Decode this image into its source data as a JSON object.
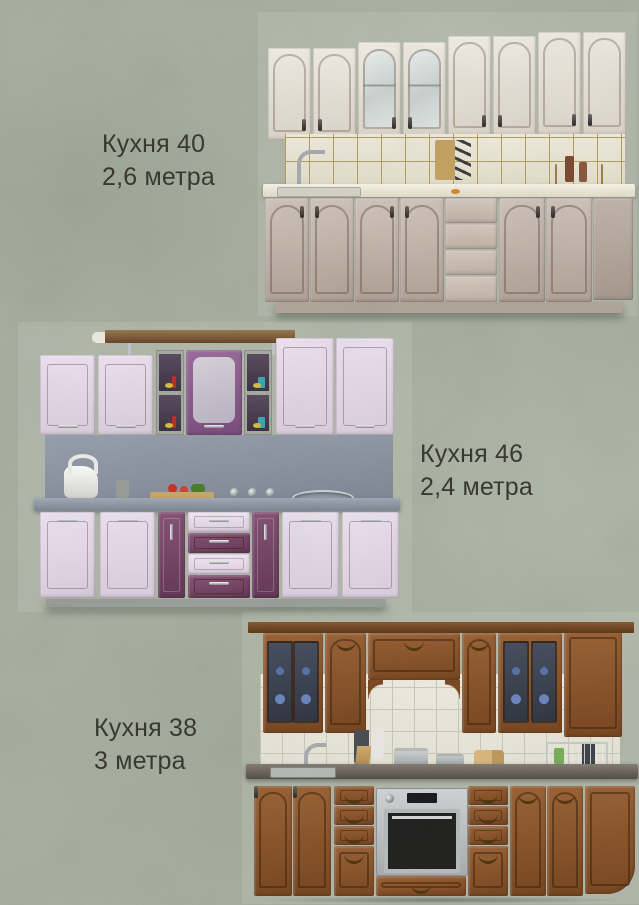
{
  "page": {
    "background_color": "#a9b1a2",
    "texture": "mottled gray-green stucco",
    "text_color": "#3a3a33"
  },
  "kitchens": [
    {
      "label": "Кухня 40",
      "dimension": "2,6 метра",
      "caption_side": "left-of-photo",
      "style": "classic cream set with arched fronts, two glass upper doors, beige tiled splashback, drawer stack",
      "colors": {
        "upper_doors": "#ece7df",
        "lower_doors": "#c4b7ad",
        "tile": "#ece7d6",
        "grout": "#b79d62",
        "countertop": "#f4f1e4"
      }
    },
    {
      "label": "Кухня  46",
      "dimension": "2,4 метра",
      "caption_side": "right-of-photo",
      "style": "modern two-tone lavender and plum set, open shelves and glass centre door, grey splash and worktop",
      "colors": {
        "light_doors": "#e9ddeb",
        "plum_accent": "#7d4b6b",
        "splash": "#8d95a3",
        "countertop": "#8a92a0"
      }
    },
    {
      "label": "Кухня 38",
      "dimension": "3 метра",
      "caption_side": "left-of-photo",
      "style": "classic wood set with centre arch, glass uppers with blue plates, white tiles, built-in steel oven",
      "colors": {
        "wood": "#8a5530",
        "tile": "#edebdf",
        "countertop": "#5f5850",
        "oven": "#b9bcbd"
      }
    }
  ]
}
